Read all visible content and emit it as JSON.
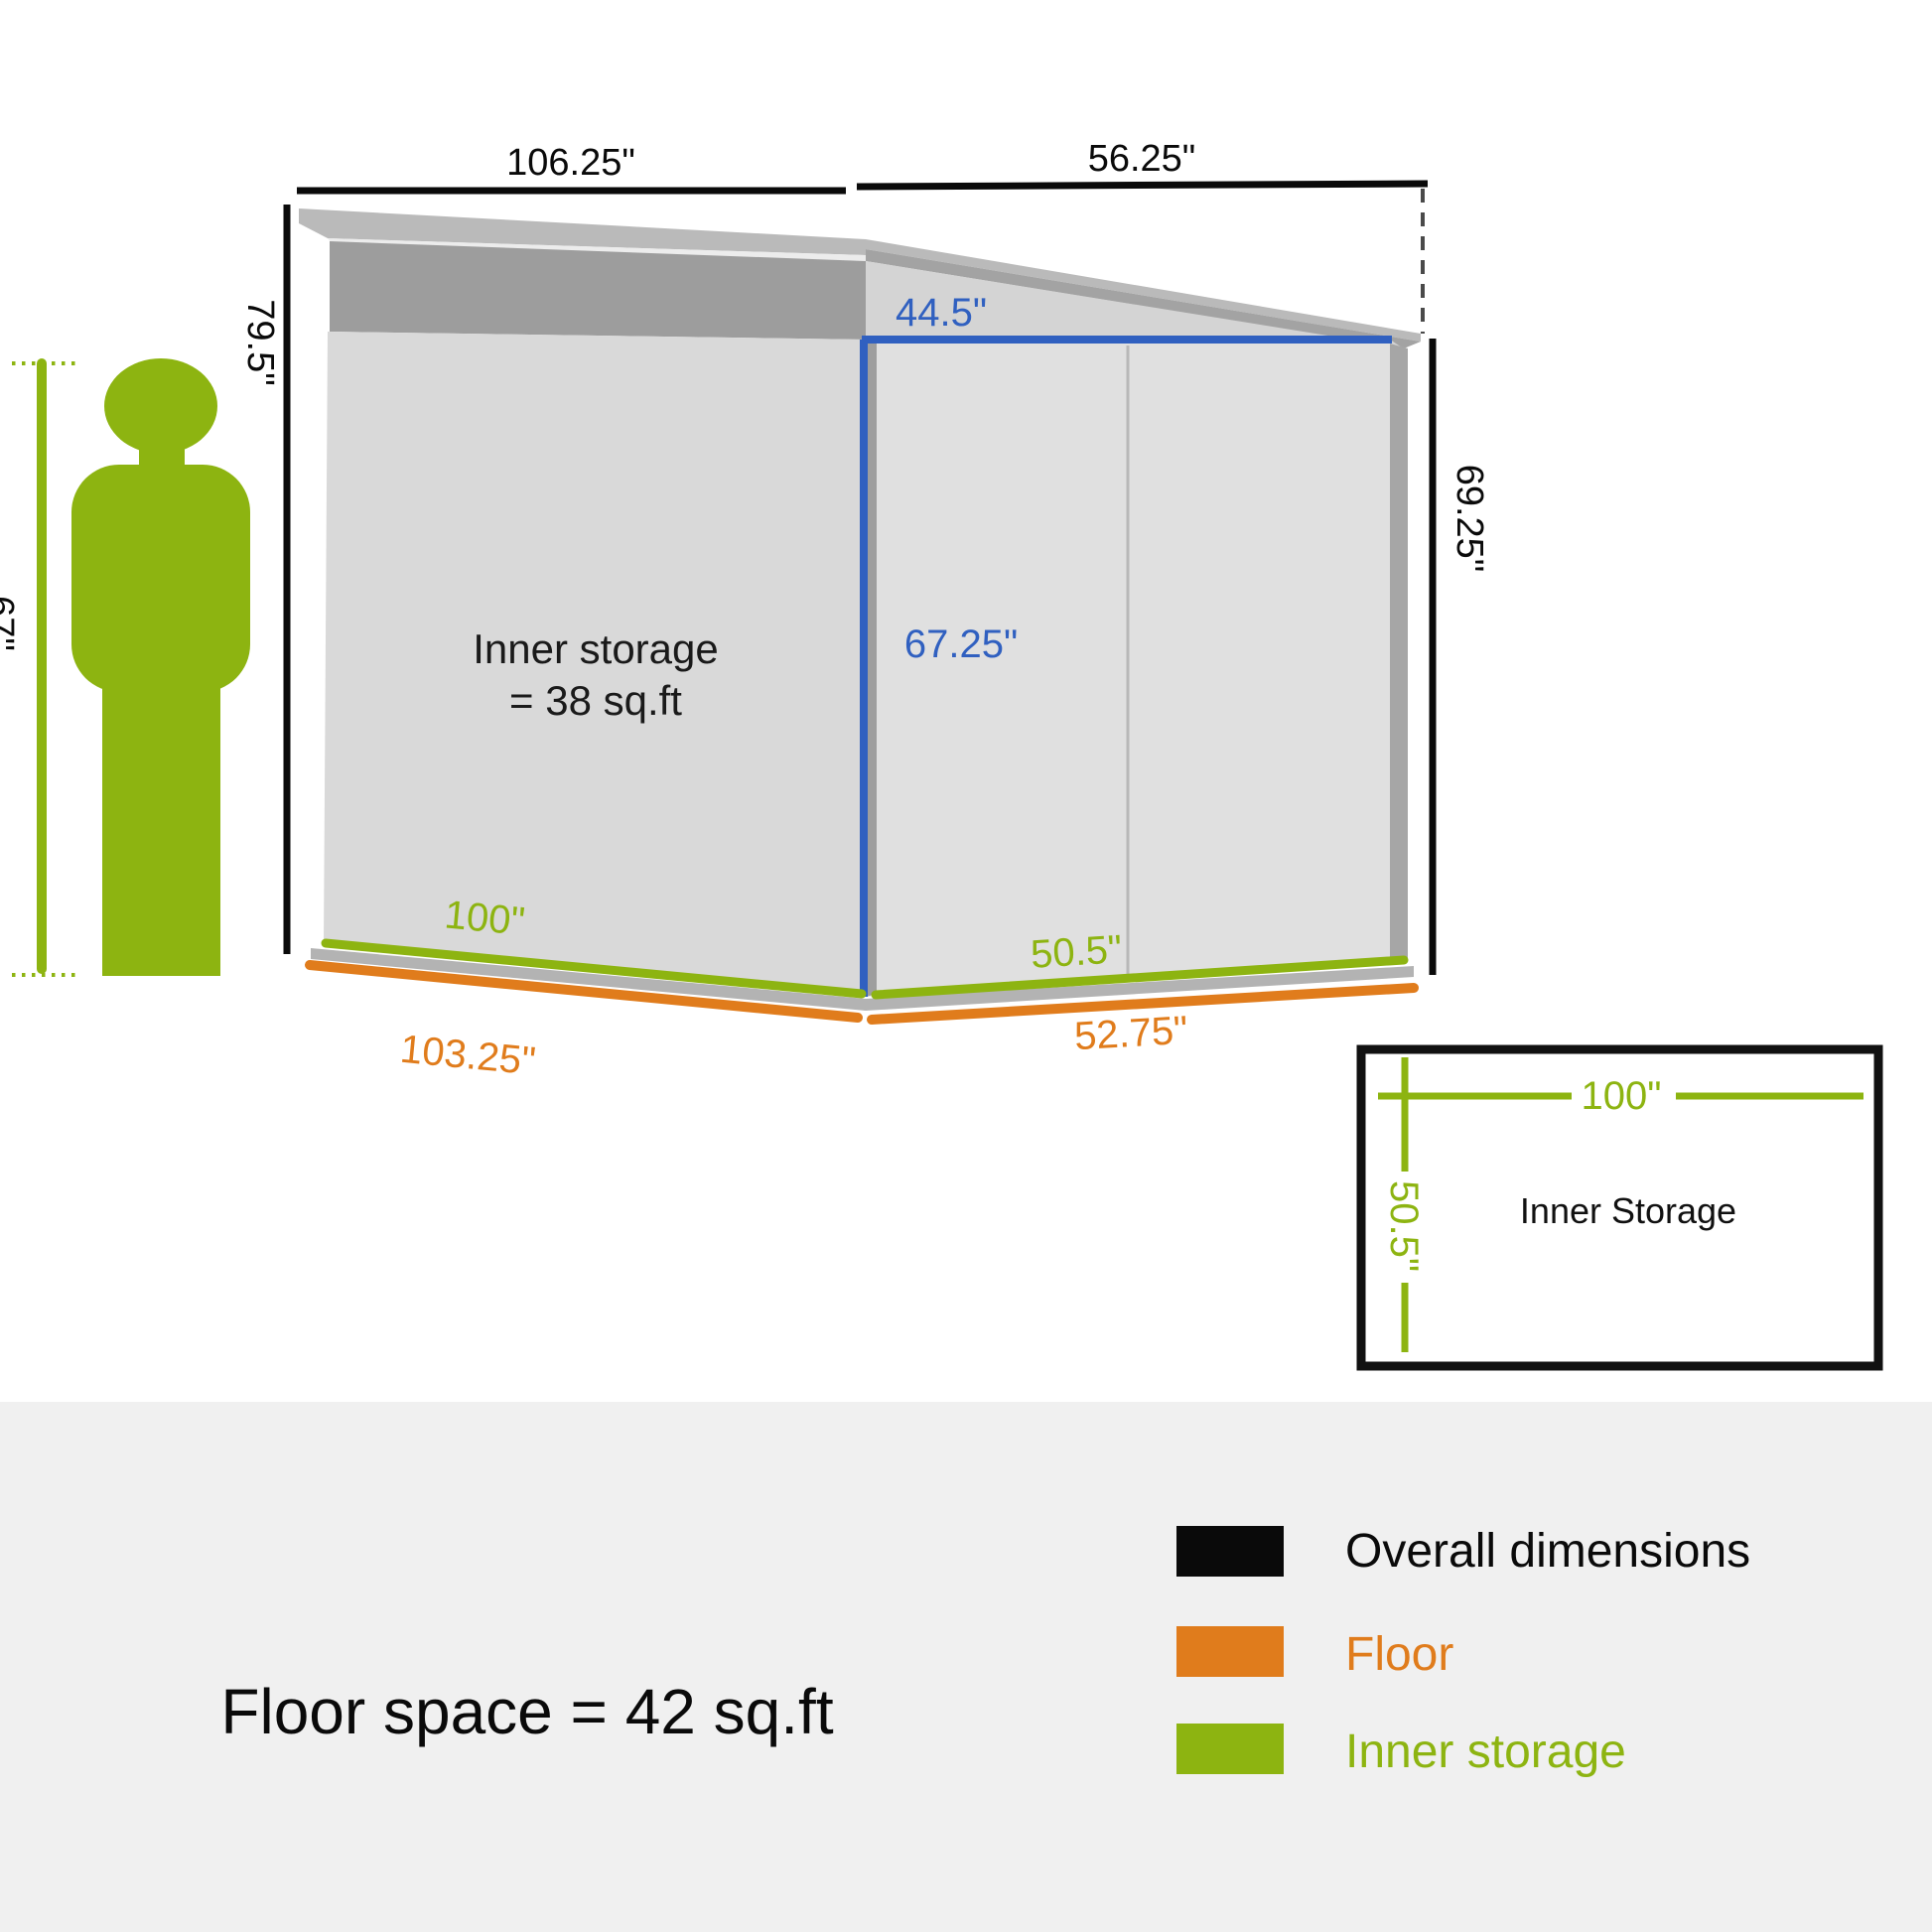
{
  "colors": {
    "green": "#8db411",
    "orange": "#e07c1c",
    "blue": "#3060c0",
    "black": "#0a0a0a",
    "wall_left": "#d9d9d9",
    "wall_right": "#e0e0e0",
    "gable": "#d4d4d4",
    "fascia": "#9d9d9d",
    "roof_light": "#bababa",
    "roof_dark": "#a3a3a3",
    "base_gray": "#b3b3b3",
    "footer_band": "#f0f0f0"
  },
  "diagram": {
    "dim_top_left": "106.25\"",
    "dim_top_right": "56.25\"",
    "dim_height_left": "79.5\"",
    "dim_height_right": "69.25\"",
    "person_height": "67\"",
    "inner_label_line1": "Inner storage",
    "inner_label_line2": "= 38 sq.ft",
    "door_opening_width": "44.5\"",
    "door_opening_height": "67.25\"",
    "inner_bottom_left": "100\"",
    "inner_bottom_right": "50.5\"",
    "floor_bottom_left": "103.25\"",
    "floor_bottom_right": "52.75\""
  },
  "top_view": {
    "title": "Inner Storage",
    "width_label": "100\"",
    "depth_label": "50.5\""
  },
  "footer": {
    "floor_space": "Floor space = 42 sq.ft",
    "legend": [
      {
        "label": "Overall dimensions",
        "color": "#0a0a0a"
      },
      {
        "label": "Floor",
        "color": "#e07c1c"
      },
      {
        "label": "Inner storage",
        "color": "#8db411"
      }
    ]
  }
}
